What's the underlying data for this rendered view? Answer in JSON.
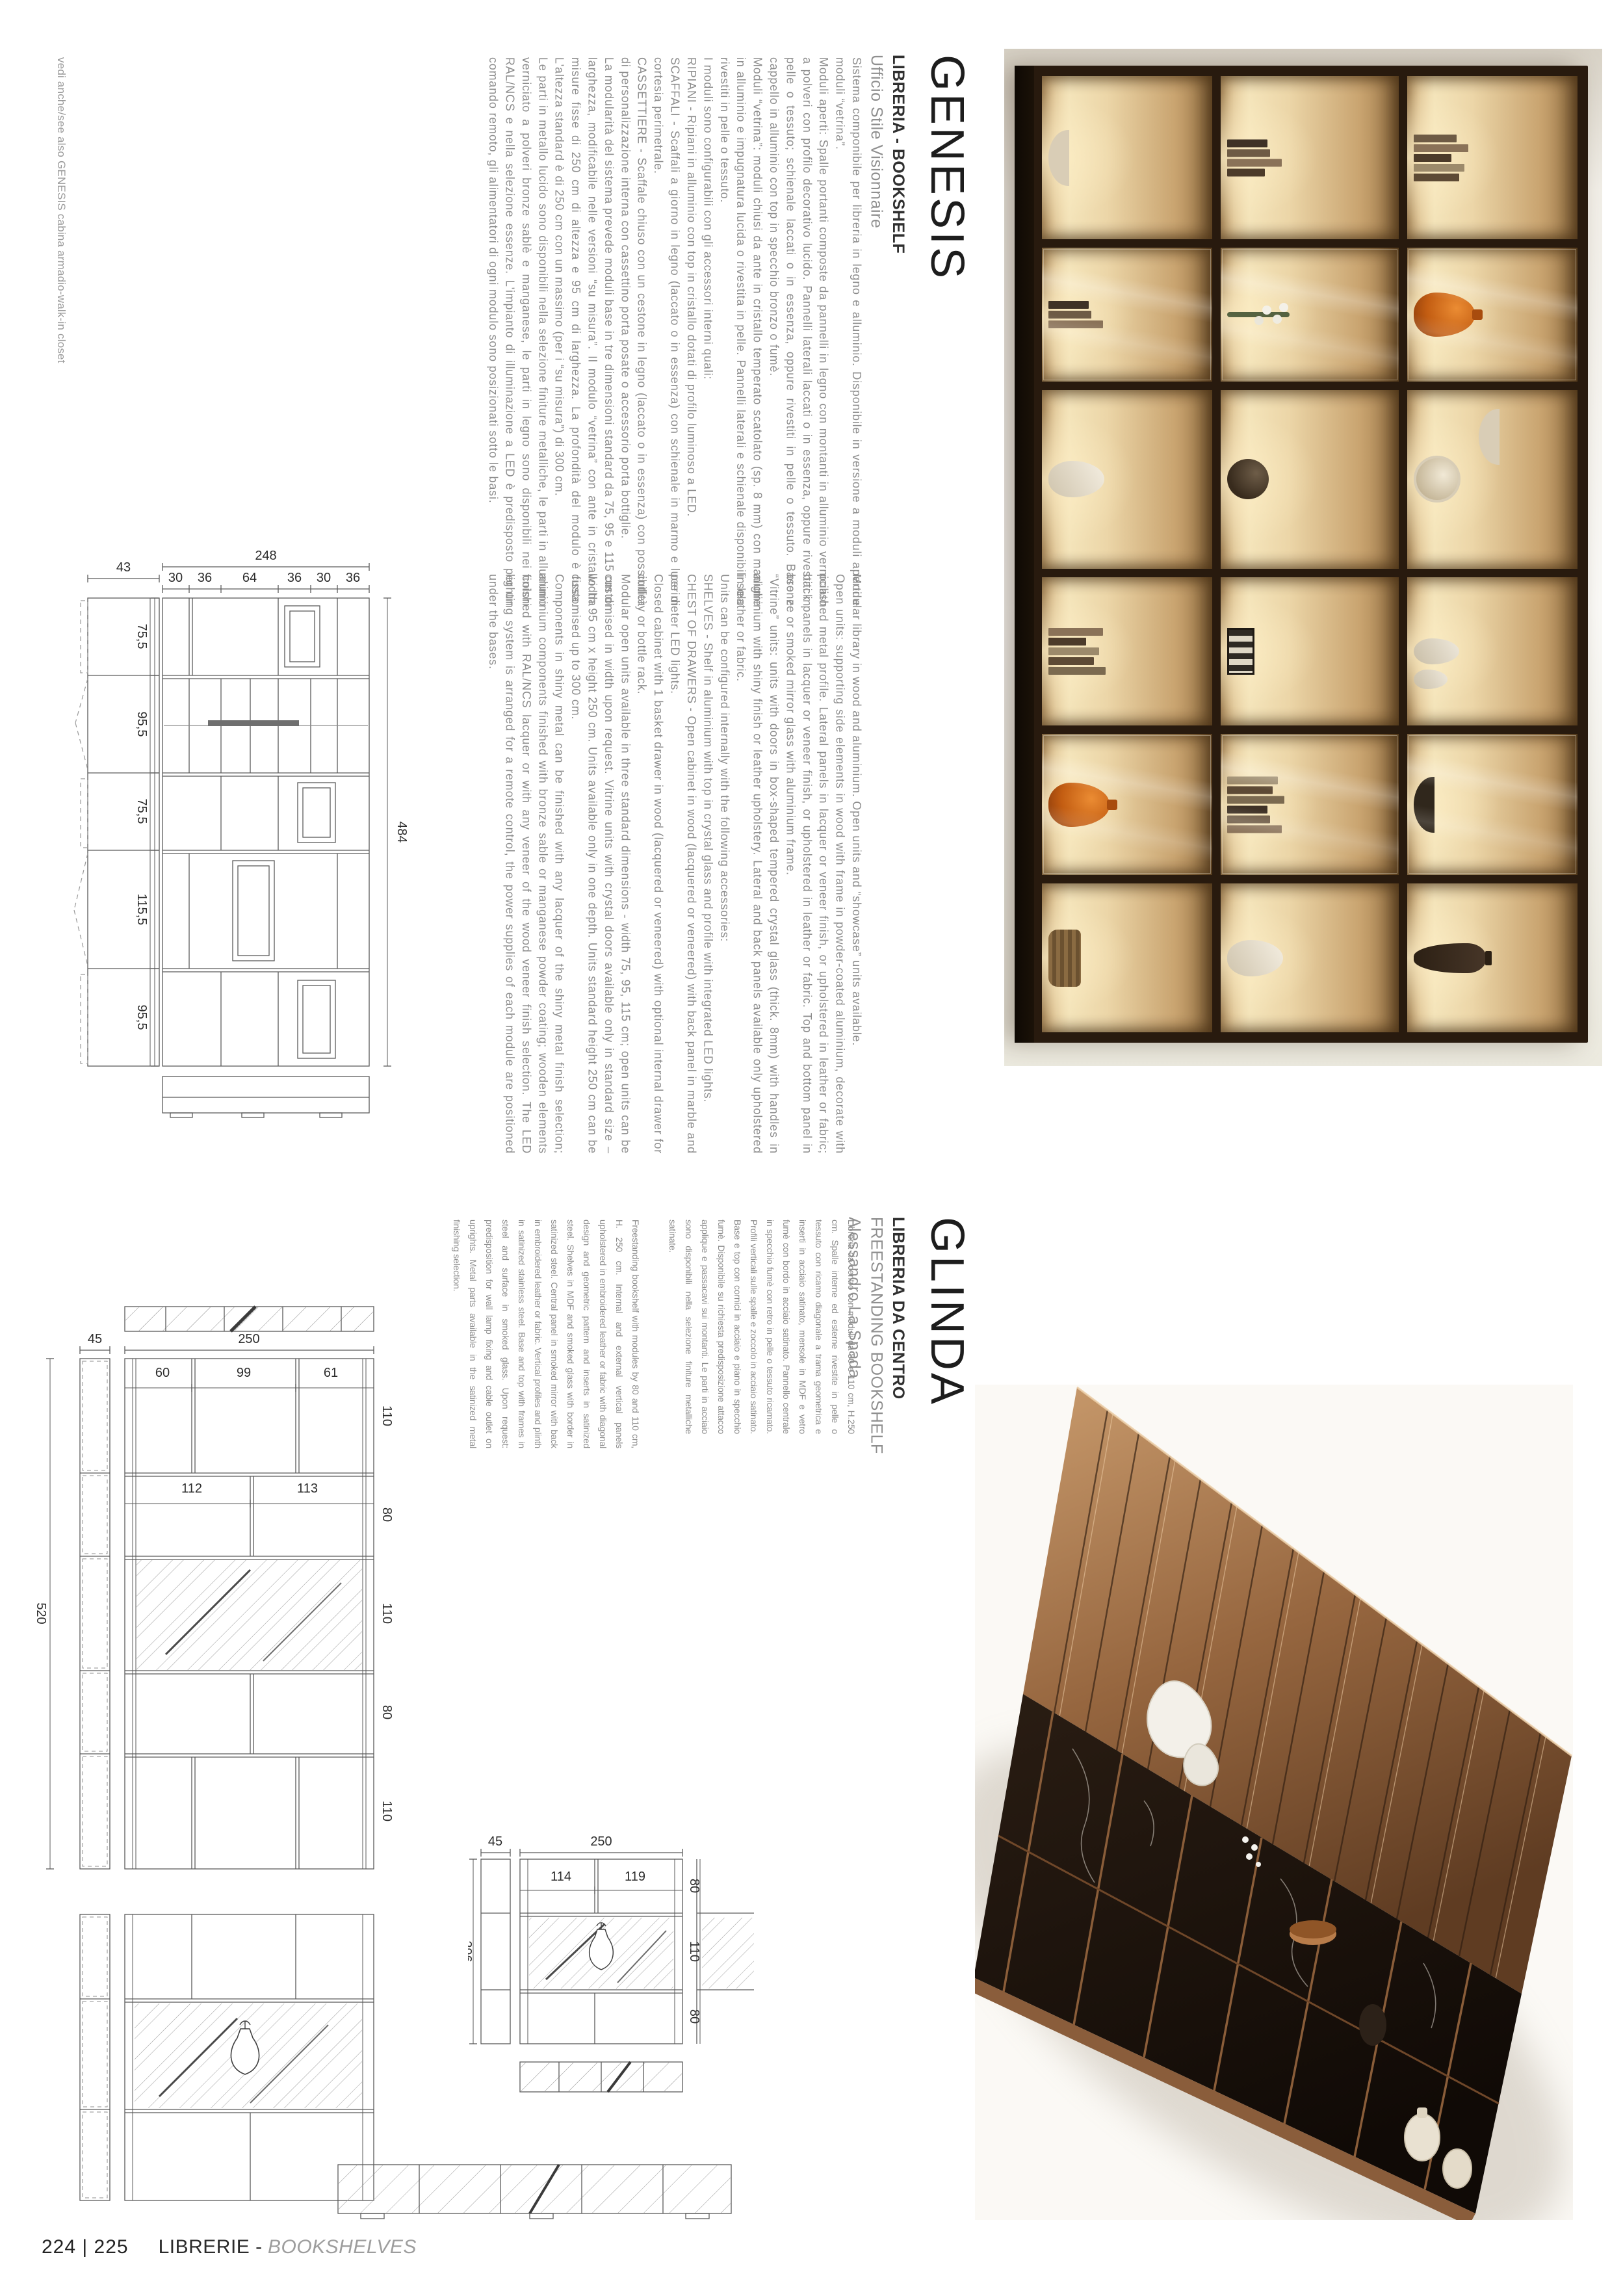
{
  "sidenote": "vedi anche/see also GENESIS cabina armadio-walk-in closet",
  "footer": {
    "pages": "224 | 225",
    "label_it": "LIBRERIE -",
    "label_en": "BOOKSHELVES"
  },
  "genesis": {
    "title": "GENESIS",
    "subtitle": "LIBRERIA - BOOKSHELF",
    "studio": "Ufficio Stile Visionnaire",
    "text_it": "Sistema componibile per libreria in legno e alluminio. Disponibile in versione a moduli aperti e moduli “vetrina”.\nModuli aperti: Spalle portanti composte da pannelli in legno con montanti in alluminio verniciato a polveri con profilo decorativo lucido. Pannelli laterali laccati o in essenza, oppure rivestiti in pelle o tessuto; schienale laccati o in essenza, oppure rivestiti in pelle o tessuto. Base e cappello in alluminio con top in specchio bronzo o fumè.\nModuli “vetrina”: moduli chiusi da ante in cristallo temperato scatolato (sp. 8 mm) con maniglie in alluminio e impugnatura lucida o rivestita in pelle. Pannelli laterali e schienale disponibili solo rivestiti in pelle o tessuto.\nI moduli sono configurabili con gli accessori interni quali:\nRIPIANI - Ripiani in alluminio con top in cristallo dotati di profilo luminoso a LED.\nSCAFFALI - Scaffali a giorno in legno (laccato o in essenza) con schienale in marmo e luce di cortesia perimetrale.\nCASSETTIERE - Scaffale chiuso con un cestone in legno (laccato o in essenza) con possibilità di personalizzazione interna con cassettino porta posate o accessorio porta bottiglie.\nLa modularità del sistema prevede moduli base in tre dimensioni standard da 75, 95 e 115 cm di larghezza, modificabile nelle versioni “su misura”. Il modulo “vetrina” con ante in cristallo ha misure fisse di 250 cm di altezza e 95 cm di larghezza. La profondità del modulo è fissa. L'altezza standard è di 250 cm con un massimo (per i “su misura”) di 300 cm.\nLe parti in metallo lucido sono disponibili nella selezione finiture metalliche, le parti in alluminio verniciato a polveri bronze sablè e manganese, le parti in legno sono disponibili nei colori RAL/NCS e nella selezione essenze. L'impianto di illuminazione a LED è predisposto per un comando remoto, gli alimentatori di ogni modulo sono posizionati sotto le basi.",
    "text_en": "Modular library in wood and aluminium. Open units and “showcase” units available.\nOpen units: supporting side elements in wood with frame in powder-coated aluminium, decorate with polished metal profile. Lateral panels in lacquer or veneer finish, or upholstered in leather or fabric; back panels in lacquer or veneer finish, or upholstered in leather or fabric. Top and bottom panel in bronze or smoked mirror glass with aluminium frame.\n“Vitrine” units: units with doors in box-shaped tempered crystal glass (thick. 8mm) with handles in aluminium with shiny finish or leather upholstery. Lateral and back panels available only upholstered in leather or fabric.\nUnits can be configured internally with the following accessories:\nSHELVES - Shelf in aluminium with top in crystal glass and profile with integrated LED lights.\nCHEST OF DRAWERS - Open cabinet in wood (lacquered or veneered) with back panel in marble and perimeter LED lights.\nClosed cabinet with 1 basket drawer in wood (lacquered or veneered) with optional internal drawer for cutlery or bottle rack.\nModular open units available in three standard dimensions - width 75, 95, 115 cm; open units can be customised in width upon request. Vitrine units with crystal doors available only in standard size – width 95 cm x height 250 cm. Units available only in one depth. Units standard height 250 cm can be customised up to 300 cm.\nComponents in shiny metal can be finished with any lacquer of the shiny metal finish selection; aluminium components finished with bronze sable or manganese powder coating; wooden elements finished with RAL/NCS lacquer or with any veneer of the wood veneer finish selection. The LED lighting system is arranged for a remote control, the power supplies of each module are positioned under the bases.",
    "drawing": {
      "side_width": "43",
      "total_height": "248",
      "cols": [
        "30",
        "36",
        "64",
        "36",
        "30",
        "36"
      ],
      "rows": [
        "75,5",
        "95,5",
        "75,5",
        "115,5",
        "95,5"
      ],
      "total_width": "484"
    }
  },
  "glinda": {
    "title": "GLINDA",
    "subtitle": "LIBRERIA DA CENTRO",
    "subtitle_en": "FREESTANDING BOOKSHELF",
    "designer": "Alessandro La Spada",
    "text_it": "Libreria da centro con moduli da 80 e 110 cm, H.250 cm. Spalle interne ed esterne rivestite in pelle o tessuto con ricamo diagonale a trama geometrica e inserti in acciaio satinato, mensole in MDF e vetro fumè con bordo in acciaio satinato. Pannello centrale in specchio fumè con retro in pelle o tessuto ricamato. Profili verticali sulle spalle e zoccolo in acciaio satinato. Base e top con cornici in acciaio e piano in specchio fumè. Disponibile su richiesta predisposizione attacco applique e passacavi sui montanti. Le parti in acciaio sono disponibili nella selezione finiture metalliche satinate.",
    "text_en": "Freestanding bookshelf with modules by 80 and 110 cm, H. 250 cm. Internal and external vertical panels upholstered in embroidered leather or fabric with diagonal design and geometric pattern and inserts in satinized steel. Shelves in MDF and smoked glass with border in satinized steel. Central panel in smoked mirror with back in embroidered leather or fabric. Vertical profiles and plinth in satinized stainless steel. Base and top with frames in steel and surface in smoked glass. Upon request: predisposition for wall lamp fixing and cable outlet on uprights. Metal parts available in the satinized metal finishing selection.",
    "drawing_a": {
      "side": "45",
      "width": "250",
      "total": "520",
      "rows": [
        "110",
        "80",
        "110",
        "80",
        "110"
      ],
      "cols_row1": [
        "60",
        "99",
        "61"
      ],
      "cols_row2": [
        "112",
        "113"
      ]
    },
    "drawing_b": {
      "side": "45",
      "width": "250",
      "total": "296",
      "rows": [
        "80",
        "110",
        "80"
      ],
      "cols": [
        "114",
        "119"
      ]
    }
  }
}
